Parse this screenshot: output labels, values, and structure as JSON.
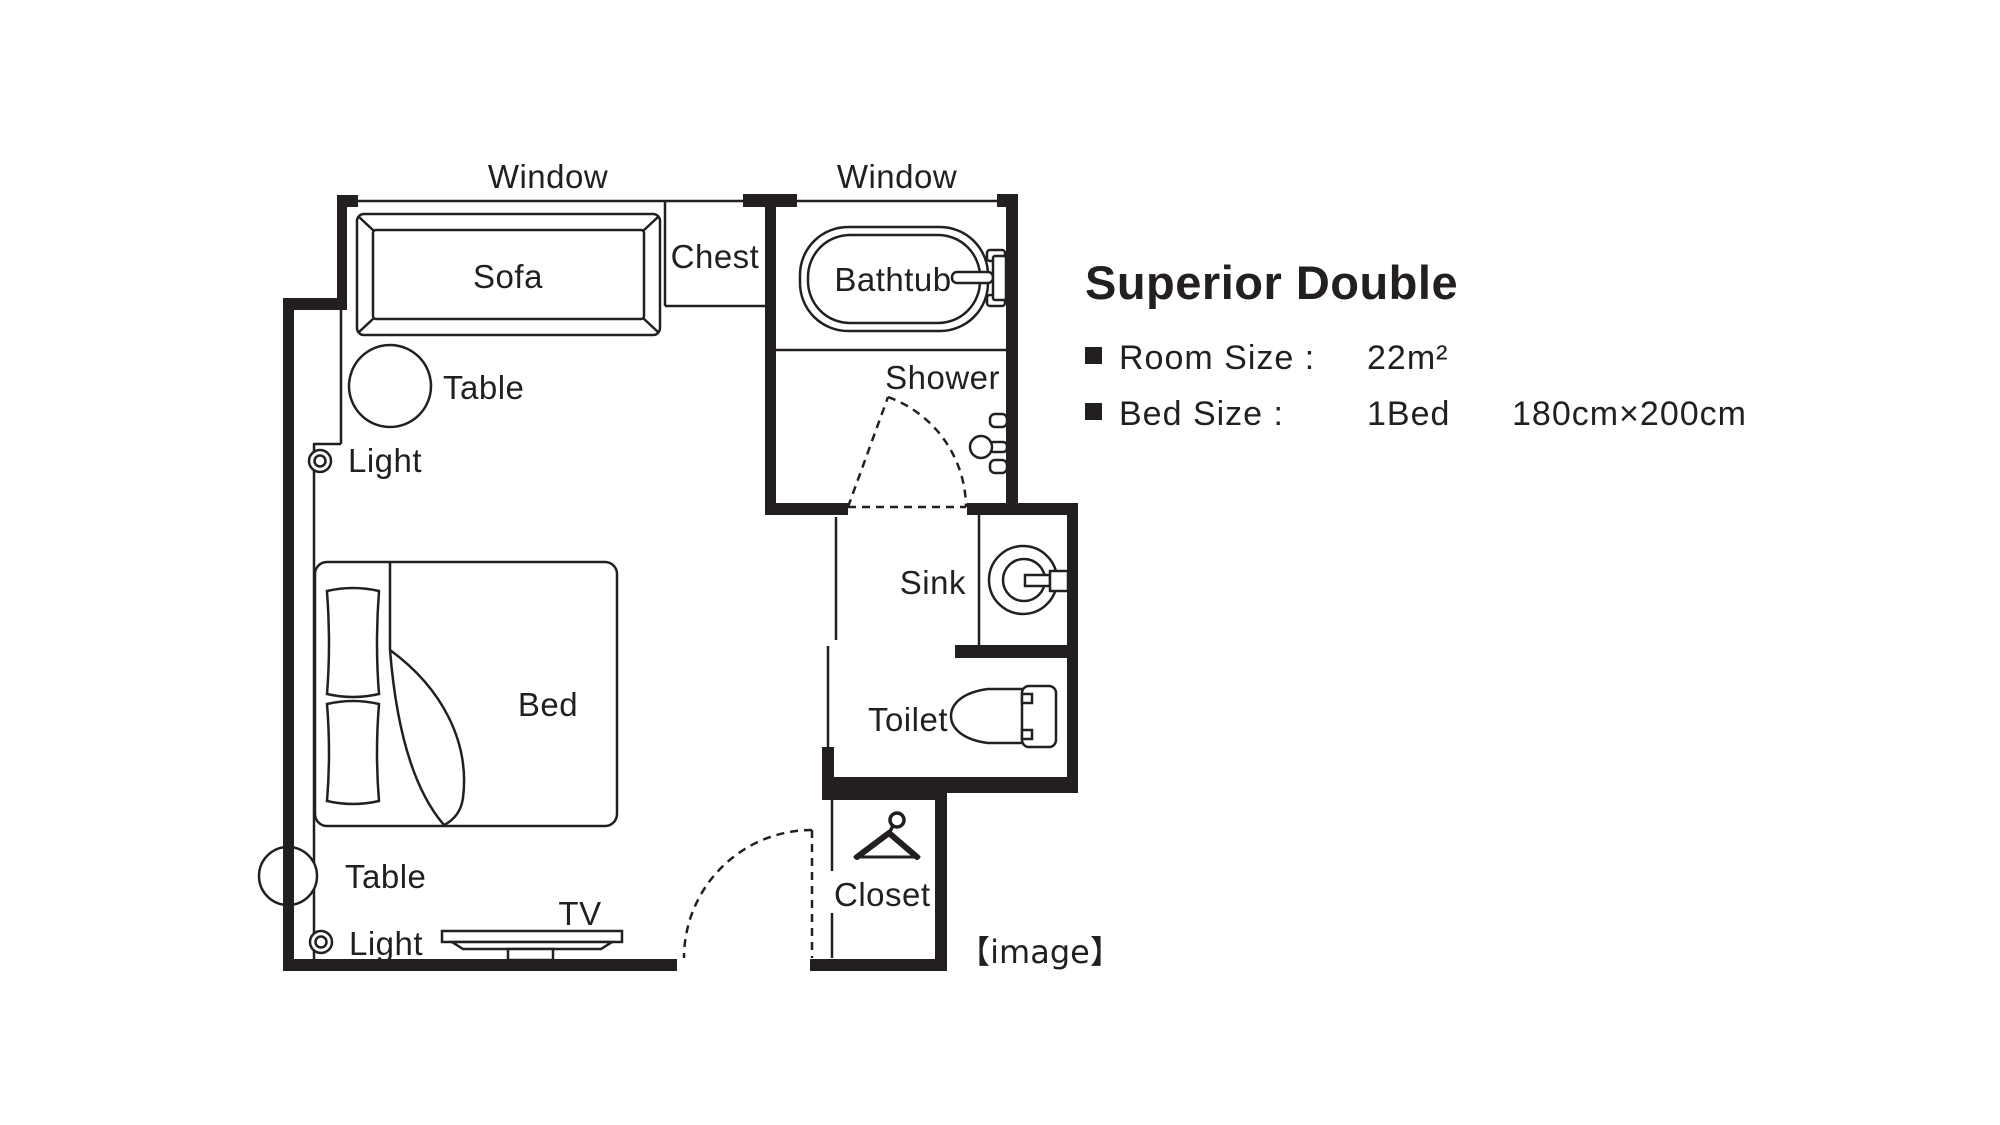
{
  "colors": {
    "ink": "#231f20",
    "background": "#ffffff"
  },
  "floor_plan": {
    "window_left": "Window",
    "window_right": "Window",
    "sofa": "Sofa",
    "chest": "Chest",
    "bathtub": "Bathtub",
    "shower": "Shower",
    "sink": "Sink",
    "toilet": "Toilet",
    "closet": "Closet",
    "bed": "Bed",
    "tv": "TV",
    "table_upper": "Table",
    "table_lower": "Table",
    "light_upper": "Light",
    "light_lower": "Light",
    "caption": "【image】"
  },
  "info": {
    "title": "Superior Double",
    "room_size_label": "Room Size :",
    "room_size_value": "22m²",
    "bed_size_label": "Bed Size :",
    "bed_count": "1Bed",
    "bed_dimensions": "180cm×200cm"
  }
}
